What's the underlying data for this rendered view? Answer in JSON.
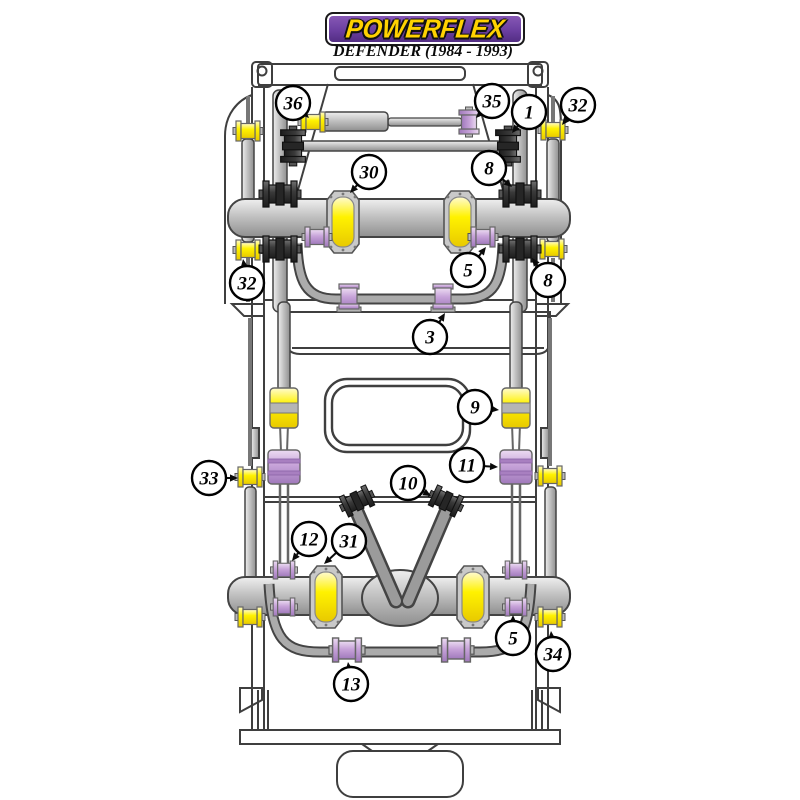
{
  "header": {
    "logo_text": "POWERFLEX",
    "subtitle": "DEFENDER (1984 - 1993)"
  },
  "colors": {
    "logo_purple": "#6b3fa0",
    "logo_purple_light": "#8a5bb8",
    "logo_yellow": "#ffd200",
    "part_yellow": "#fff200",
    "part_purple": "#c7a3d9",
    "part_dark": "#3a3a3a",
    "metal_gray": "#c2c2c2",
    "line": "#3f3f3f"
  },
  "callouts": [
    {
      "label": "36",
      "cx": 293,
      "cy": 103,
      "tx": 309,
      "ty": 118
    },
    {
      "label": "35",
      "cx": 492,
      "cy": 101,
      "tx": 476,
      "ty": 118
    },
    {
      "label": "1",
      "cx": 529,
      "cy": 112,
      "tx": 512,
      "ty": 133
    },
    {
      "label": "32",
      "cx": 578,
      "cy": 105,
      "tx": 562,
      "ty": 125
    },
    {
      "label": "30",
      "cx": 369,
      "cy": 172,
      "tx": 350,
      "ty": 193
    },
    {
      "label": "8",
      "cx": 489,
      "cy": 168,
      "tx": 512,
      "ty": 187
    },
    {
      "label": "5",
      "cx": 468,
      "cy": 270,
      "tx": 486,
      "ty": 247
    },
    {
      "label": "32",
      "cx": 247,
      "cy": 283,
      "tx": 243,
      "ty": 259
    },
    {
      "label": "8",
      "cx": 548,
      "cy": 280,
      "tx": 532,
      "ty": 258
    },
    {
      "label": "3",
      "cx": 430,
      "cy": 337,
      "tx": 445,
      "ty": 313
    },
    {
      "label": "9",
      "cx": 475,
      "cy": 407,
      "tx": 499,
      "ty": 410
    },
    {
      "label": "11",
      "cx": 467,
      "cy": 465,
      "tx": 498,
      "ty": 467
    },
    {
      "label": "33",
      "cx": 209,
      "cy": 478,
      "tx": 238,
      "ty": 478
    },
    {
      "label": "10",
      "cx": 408,
      "cy": 483,
      "tx": 431,
      "ty": 496
    },
    {
      "label": "12",
      "cx": 309,
      "cy": 539,
      "tx": 292,
      "ty": 561
    },
    {
      "label": "31",
      "cx": 349,
      "cy": 541,
      "tx": 324,
      "ty": 564
    },
    {
      "label": "5",
      "cx": 513,
      "cy": 638,
      "tx": 513,
      "ty": 615
    },
    {
      "label": "34",
      "cx": 553,
      "cy": 654,
      "tx": 551,
      "ty": 631
    },
    {
      "label": "13",
      "cx": 351,
      "cy": 684,
      "tx": 348,
      "ty": 662
    }
  ]
}
